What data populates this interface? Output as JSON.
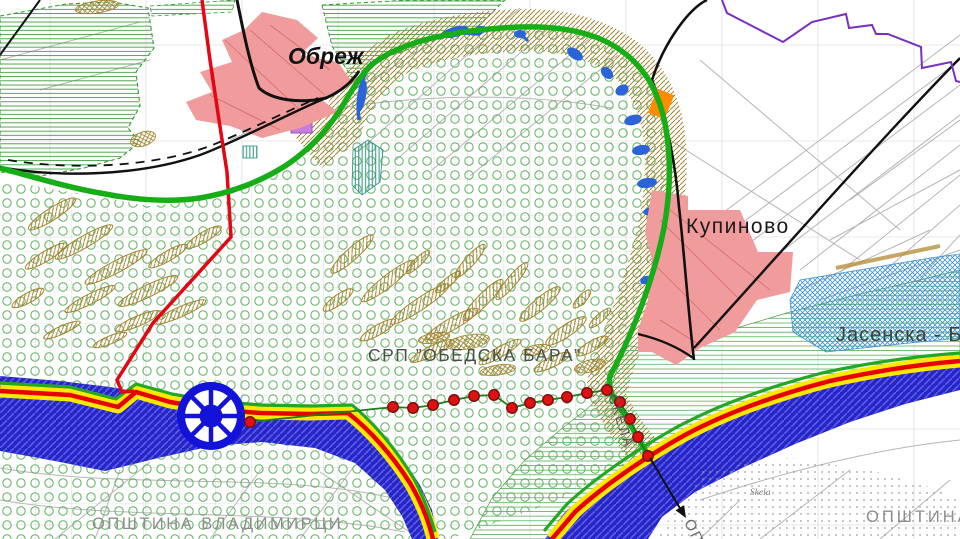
{
  "map": {
    "labels": {
      "obrez": "Обреж",
      "kupinovo": "Купиново",
      "reserve": "СРП ”ОБЕДСКА БАРА”",
      "jasenska": "Јасенска - Бе",
      "skela_ferry": "СКЕЛА",
      "skela_village": "Skela",
      "municipality_left": "ОПШТИНА  ВЛАДИМИРЦИ",
      "municipality_right": "ОПШТИНА",
      "municipality_bottom_partial": "ОПШ"
    },
    "colors": {
      "reserve_boundary": "#17ad17",
      "zone_red_line": "#e30613",
      "river_fill": "#2626c3",
      "river_hatch": "#5c5cf0",
      "road_fill": "#ffe800",
      "road_center": "#e60000",
      "road_edge_green": "#22a822",
      "settlement_pink": "#f19c9c",
      "trail_dot": "#e01111",
      "trail_dot_border": "#7d0f0f",
      "trail_line": "#1e7d1e",
      "wheel_blue": "#1212d8",
      "purple_boundary": "#7a2fc2",
      "orange_marker": "#ff8c00",
      "meadow_line": "#58ad58",
      "forest_circle": "#5fae5f",
      "crosshatch_water": "#3c93cf",
      "scar_hatch": "#a3842e",
      "teal_patch": "#2a9183",
      "violet_patch": "#c77de0",
      "label_gray": "#8d8d8d"
    },
    "features": {
      "trail_dots": [
        [
          228,
          421
        ],
        [
          250,
          422
        ],
        [
          393,
          407
        ],
        [
          413,
          408
        ],
        [
          433,
          405
        ],
        [
          454,
          400
        ],
        [
          474,
          396
        ],
        [
          494,
          395
        ],
        [
          512,
          408
        ],
        [
          530,
          403
        ],
        [
          548,
          400
        ],
        [
          567,
          397
        ],
        [
          587,
          393
        ],
        [
          607,
          390
        ],
        [
          620,
          402
        ],
        [
          630,
          419
        ],
        [
          638,
          437
        ],
        [
          648,
          456
        ]
      ],
      "meander_scars": [
        [
          52,
          214,
          28,
          6,
          -33
        ],
        [
          84,
          242,
          33,
          6,
          -30
        ],
        [
          116,
          267,
          35,
          6,
          -28
        ],
        [
          148,
          291,
          33,
          6,
          -26
        ],
        [
          180,
          312,
          28,
          5,
          -24
        ],
        [
          46,
          256,
          24,
          5,
          -31
        ],
        [
          90,
          299,
          28,
          5,
          -27
        ],
        [
          138,
          321,
          24,
          5,
          -23
        ],
        [
          28,
          298,
          18,
          5,
          -29
        ],
        [
          204,
          237,
          20,
          5,
          -31
        ],
        [
          168,
          256,
          22,
          5,
          -30
        ],
        [
          62,
          330,
          20,
          4,
          -24
        ],
        [
          110,
          340,
          18,
          4,
          -22
        ],
        [
          352,
          254,
          28,
          6,
          -42
        ],
        [
          388,
          281,
          33,
          6,
          -38
        ],
        [
          420,
          304,
          35,
          6,
          -34
        ],
        [
          452,
          324,
          30,
          6,
          -30
        ],
        [
          483,
          300,
          28,
          6,
          -46
        ],
        [
          512,
          281,
          24,
          5,
          -50
        ],
        [
          540,
          304,
          26,
          6,
          -40
        ],
        [
          566,
          331,
          24,
          6,
          -34
        ],
        [
          592,
          346,
          18,
          5,
          -30
        ],
        [
          470,
          261,
          22,
          5,
          -48
        ],
        [
          432,
          351,
          24,
          5,
          -26
        ],
        [
          500,
          352,
          24,
          5,
          -30
        ],
        [
          552,
          362,
          20,
          5,
          -26
        ],
        [
          378,
          330,
          20,
          5,
          -30
        ],
        [
          338,
          300,
          18,
          5,
          -36
        ],
        [
          600,
          318,
          14,
          4,
          -42
        ],
        [
          582,
          299,
          12,
          4,
          -46
        ],
        [
          418,
          262,
          16,
          4,
          -44
        ],
        [
          448,
          282,
          16,
          4,
          -40
        ]
      ],
      "scrub_patches": [
        [
          97,
          7,
          22,
          6,
          -8
        ],
        [
          143,
          139,
          13,
          7,
          -18
        ],
        [
          590,
          366,
          16,
          6,
          -14
        ],
        [
          498,
          370,
          18,
          5,
          -8
        ],
        [
          468,
          342,
          22,
          7,
          -10
        ],
        [
          434,
          338,
          16,
          5,
          -10
        ],
        [
          536,
          350,
          14,
          5,
          -12
        ]
      ],
      "water_patches": [
        [
          455,
          32,
          14,
          5,
          -15
        ],
        [
          480,
          30,
          7,
          4,
          -10
        ],
        [
          520,
          34,
          6,
          4,
          0
        ],
        [
          575,
          54,
          9,
          5,
          35
        ],
        [
          607,
          73,
          7,
          5,
          45
        ],
        [
          622,
          90,
          5,
          7,
          60
        ],
        [
          633,
          120,
          5,
          9,
          75
        ],
        [
          641,
          150,
          5,
          9,
          80
        ],
        [
          647,
          183,
          5,
          10,
          82
        ],
        [
          651,
          211,
          4,
          8,
          78
        ],
        [
          656,
          231,
          4,
          6,
          72
        ],
        [
          362,
          96,
          4,
          16,
          10
        ],
        [
          646,
          280,
          4,
          6,
          70
        ]
      ]
    }
  }
}
